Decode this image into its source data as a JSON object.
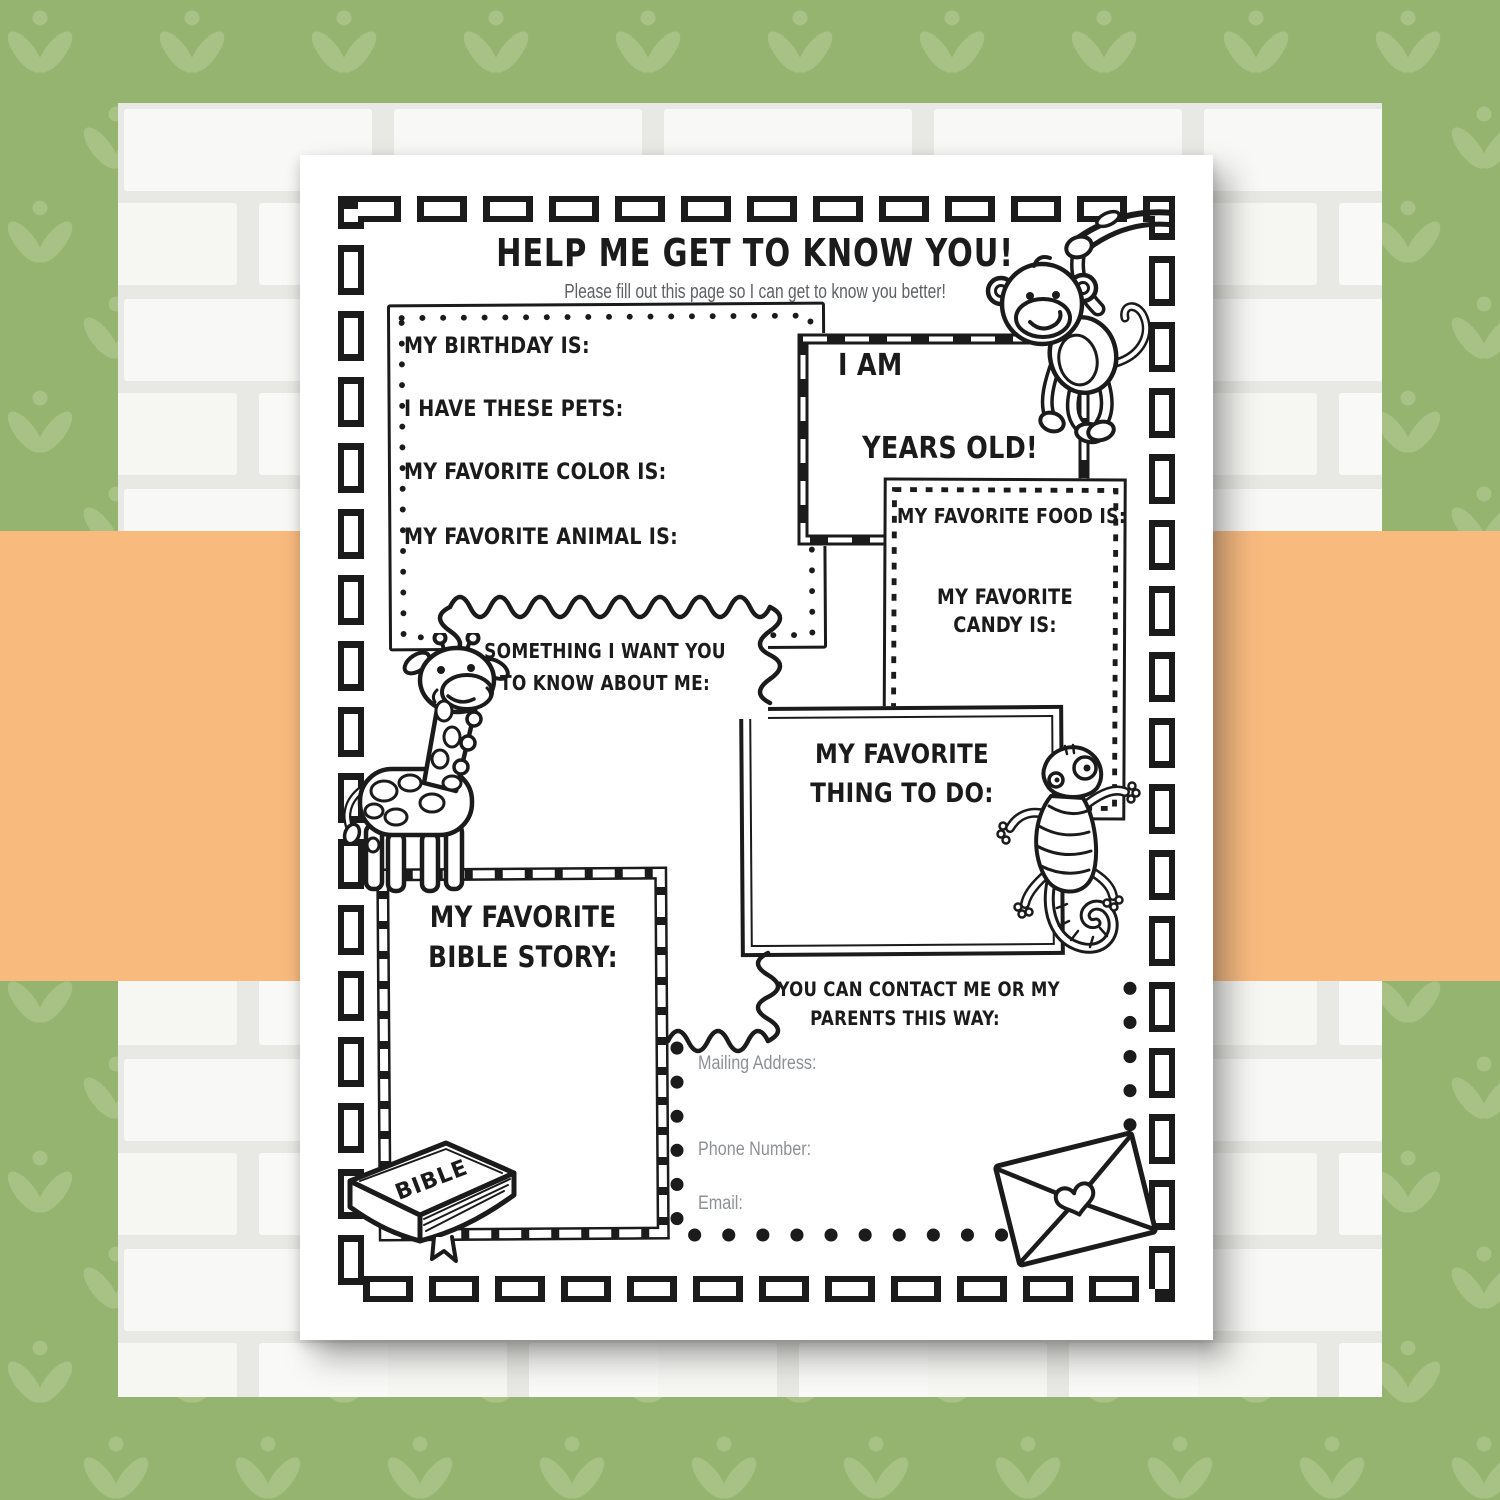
{
  "colors": {
    "green": "#95b46f",
    "green_motif": "#a8c185",
    "orange": "#f9ba7e",
    "brick": "#f8f8f6",
    "mortar": "#e8e8e4",
    "paper": "#ffffff",
    "ink": "#1b1b1b",
    "subtitle_gray": "#5d6064",
    "label_gray": "#8d9196"
  },
  "header": {
    "title": "HELP ME GET TO KNOW YOU!",
    "subtitle": "Please fill out this page so I can get to know you better!"
  },
  "about_box": {
    "fields": [
      "MY BIRTHDAY IS:",
      "I HAVE THESE PETS:",
      "MY FAVORITE COLOR IS:",
      "MY FAVORITE ANIMAL IS:"
    ]
  },
  "age_box": {
    "line1": "I AM",
    "line2": "YEARS OLD!"
  },
  "food_box": {
    "line1": "MY FAVORITE FOOD IS:",
    "line2": "MY FAVORITE CANDY IS:"
  },
  "something_box": {
    "line1": "SOMETHING I WANT YOU",
    "line2": "TO KNOW ABOUT ME:"
  },
  "thing_box": {
    "line1": "MY FAVORITE",
    "line2": "THING TO DO:"
  },
  "bible_box": {
    "line1": "MY FAVORITE",
    "line2": "BIBLE STORY:",
    "book_label": "BIBLE"
  },
  "contact_box": {
    "heading1": "YOU CAN CONTACT ME OR MY",
    "heading2": "PARENTS THIS WAY:",
    "fields": [
      "Mailing Address:",
      "Phone Number:",
      "Email:"
    ]
  },
  "clipart": {
    "monkey": "monkey hanging from branch",
    "giraffe": "standing giraffe",
    "gecko": "climbing gecko with spiral tail",
    "bible": "closed bible book",
    "envelope": "envelope sealed with heart"
  }
}
